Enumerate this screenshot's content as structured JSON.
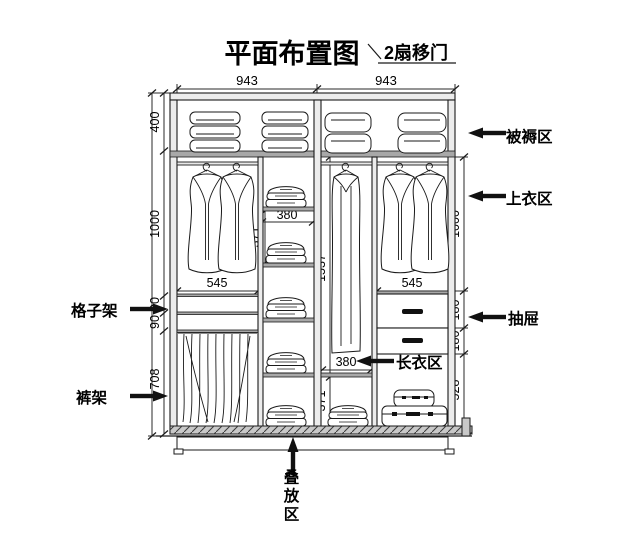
{
  "title": "平面布置图",
  "door_note": "2扇移门",
  "callouts": {
    "bedding": "被褥区",
    "tops": "上衣区",
    "drawer": "抽屉",
    "long_clothes": "长衣区",
    "grid_shelf": "格子架",
    "pants_rack": "裤架",
    "stacking": "叠放区"
  },
  "dims": {
    "top_width_left": "943",
    "top_width_right": "943",
    "bedding_height": "400",
    "left_hang_height": "1000",
    "grid_cell_1": "90",
    "grid_cell_2": "90",
    "pants_height": "708",
    "right_hang_height": "1000",
    "drawer_1": "180",
    "drawer_2": "180",
    "bottom_right_height": "528",
    "shelf_col_width": "380",
    "shelf_cell_height": "371",
    "long_hang_height": "1537",
    "left_hang_width": "545",
    "right_hang_width": "545",
    "long_col_width": "380",
    "long_bottom_height": "371"
  },
  "colors": {
    "line": "#1a1a1a",
    "board_fill": "#a8a8a8",
    "background": "#ffffff",
    "arrow": "#111111"
  }
}
